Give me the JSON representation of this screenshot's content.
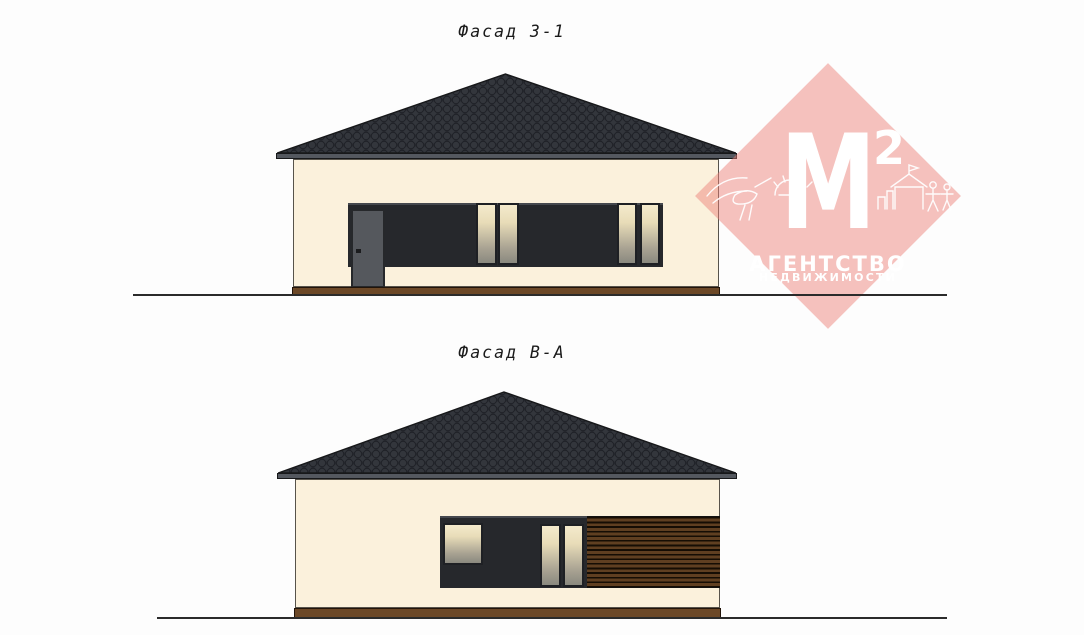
{
  "document": {
    "facade_top": {
      "title": "Фасад 3-1"
    },
    "facade_bottom": {
      "title": "Фасад В-А"
    }
  },
  "watermark": {
    "letter": "M",
    "superscript": "2",
    "agency_line1": "АГЕНТСТВО",
    "agency_line2": "НЕДВИЖИМОСТИ"
  },
  "colors": {
    "page_bg": "#FDFDFD",
    "title_ink": "#1A1A1A",
    "roof_fill": "#3B3E44",
    "roof_scale_fill": "#33363C",
    "roof_scale_line": "#1F2127",
    "roof_outline": "#17181A",
    "fascia": "#54585F",
    "wall": "#FBF1DC",
    "wall_outline": "#57534B",
    "plinth": "#6C4827",
    "plinth_outline": "#221409",
    "panel": "#26282C",
    "panel_highlight": "#45484E",
    "door": "#55585D",
    "door_outline": "#26282B",
    "window_frame": "#1E2024",
    "glass_top": "#F4EACC",
    "glass_bottom": "#8A897F",
    "wood_light": "#5F3F21",
    "wood_dark": "#150D04",
    "ground": "#2B2B2B",
    "watermark_pink": "rgba(236,128,120,0.48)",
    "watermark_white": "#FFFFFF"
  }
}
